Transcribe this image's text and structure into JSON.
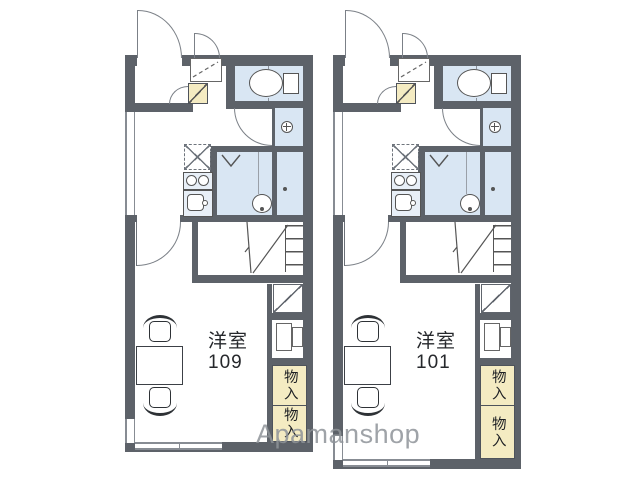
{
  "floorplan": {
    "watermark": "Apamanshop",
    "units": [
      {
        "room_type": "洋室",
        "room_number": "109",
        "closets": [
          {
            "label": "物入"
          },
          {
            "label": "物入"
          }
        ]
      },
      {
        "room_type": "洋室",
        "room_number": "101",
        "closets": [
          {
            "label": "物入"
          },
          {
            "label": "物入"
          }
        ]
      }
    ],
    "colors": {
      "wall": "#5d6269",
      "wet_area": "#d9e6f3",
      "closet_fill": "#f4ebc2",
      "fixture_line": "#555555",
      "door_line": "#7b8087",
      "watermark_text": "#8f9499"
    },
    "icons": {
      "toilet-icon": "oval bowl + tank rectangle",
      "washing-machine-icon": "circle with cross",
      "stove-icon": "two burner circles",
      "sink-icon": "rounded basin with drain circle",
      "bathtub-icon": "oval tub with dot",
      "fridge-space-icon": "dashed square with X",
      "door-swing-icon": "quarter arc",
      "folding-door-icon": "V chevron",
      "ladder-icon": "rungs with diagonal",
      "ac-unit-icon": "double panel rectangles",
      "shoe-cabinet-icon": "square with diagonal"
    }
  }
}
